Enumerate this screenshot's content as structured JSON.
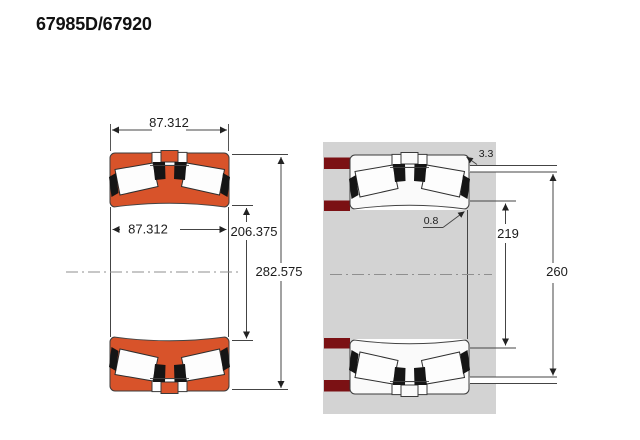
{
  "title": "67985D/67920",
  "views": {
    "left": {
      "dims": {
        "overall_width_top": "87.312",
        "inner_width": "87.312",
        "bore_diameter": "206.375",
        "outer_diameter": "282.575"
      }
    },
    "right": {
      "dims": {
        "housing_fillet_radius": "3.3",
        "shaft_fillet_radius": "0.8",
        "shaft_shoulder_diameter": "219",
        "housing_shoulder_diameter": "260"
      }
    }
  },
  "colors": {
    "ring_orange": "#d8532a",
    "steel_white": "#fafafa",
    "abutment_maroon": "#7b1114",
    "housing_gray": "#d3d3d3",
    "line": "#444444",
    "text_dark": "#1c1c1c"
  }
}
